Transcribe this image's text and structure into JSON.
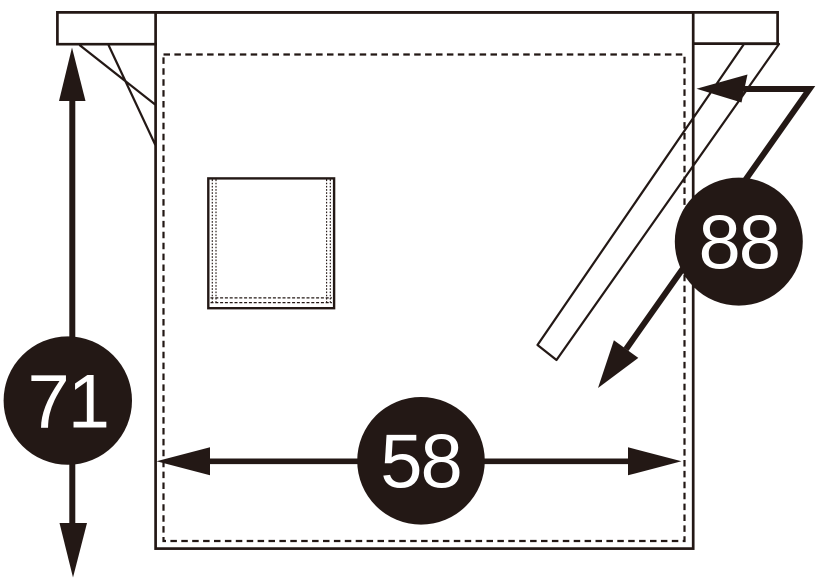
{
  "colors": {
    "ink": "#231815",
    "background": "#ffffff",
    "badge_fill": "#231815",
    "badge_text": "#ffffff"
  },
  "diagram": {
    "subject": "apron-front-view-dimension-diagram",
    "parts": {
      "waistband": "waistband with protruding ends",
      "left_tie": "tie strap hanging behind body",
      "right_tie": "tie strap hanging in front of body",
      "pocket": "square patch pocket with stitching",
      "hem": "dashed stitch border inside body outline"
    },
    "dimensions": {
      "height": {
        "value": "71",
        "orientation": "vertical",
        "measures": "body height"
      },
      "width": {
        "value": "58",
        "orientation": "horizontal",
        "measures": "body width"
      },
      "tie_length": {
        "value": "88",
        "orientation": "diagonal",
        "measures": "tie strap length"
      }
    }
  }
}
